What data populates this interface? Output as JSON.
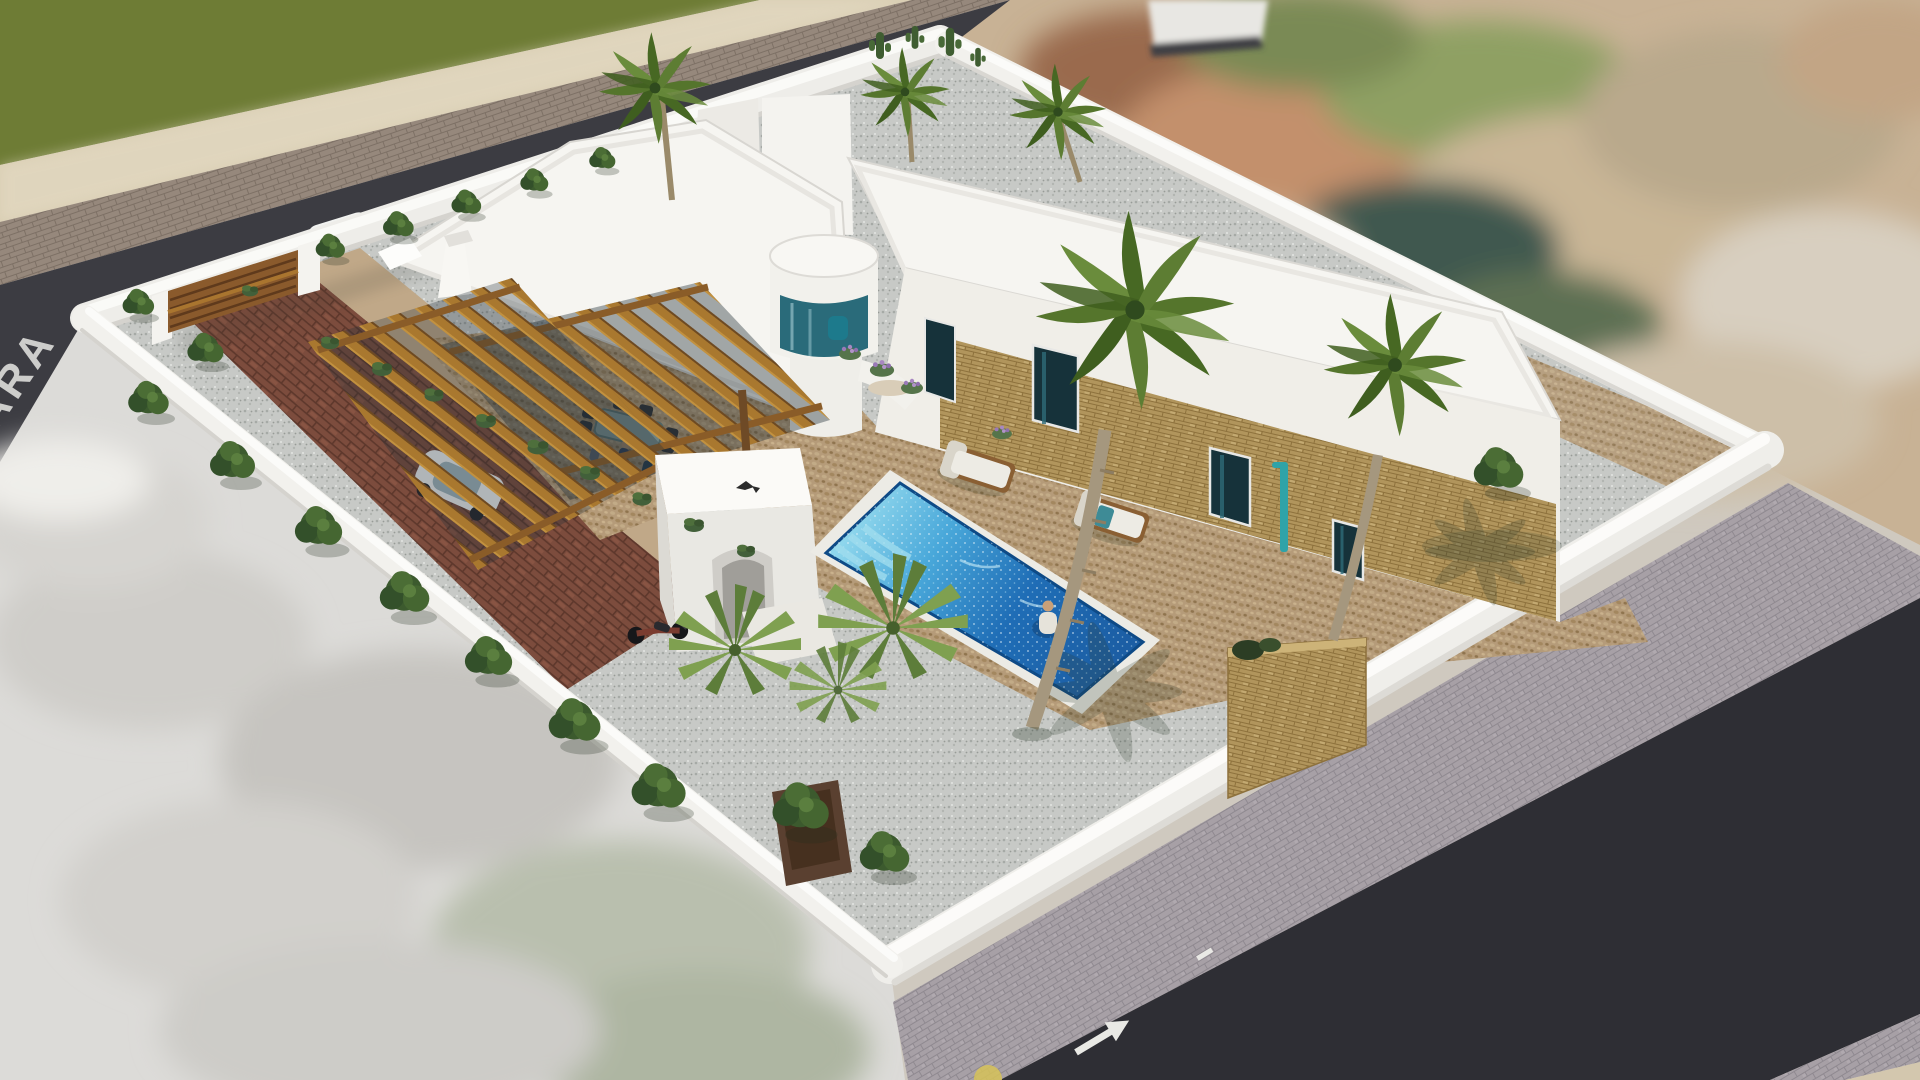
{
  "scene": {
    "title": "Aerial 3D architectural rendering of a walled Mediterranean villa with swimming pool",
    "type": "architectural-visualization",
    "view": "isometric aerial"
  },
  "road_marking": {
    "text": "ARA"
  },
  "colors": {
    "field_green": "#6e7c35",
    "sand": "#d9ceb3",
    "asphalt_top": "#3c3c42",
    "asphalt_bottom": "#2e2e34",
    "sidewalk_top": "#96887c",
    "sidewalk_bottom": "#a7a0a6",
    "wall_white": "#efeeea",
    "roof_white": "#f6f5f1",
    "facade_white": "#f0eee8",
    "deck_tan": "#b59b79",
    "gravel_gray": "#c7c9c6",
    "brick_red": "#7c4c3d",
    "pool_rim": "#ecebe5",
    "pool_deep": "#1c5ea4",
    "glass_teal": "#2a6b7a",
    "pergola_wood": "#a9782f",
    "gate_wood": "#8a5a2c",
    "stone_tan": "#b1955c",
    "palm_green": "#55752c",
    "tree_green": "#3c5a2e",
    "shower_teal": "#2fa3a8",
    "marking_white": "#f2f2ee",
    "terrain_salmon": "#c3906c",
    "arrow_white": "#e9e9e5"
  },
  "objects": {
    "main_villa": "white flat-roof villa with curved glass bay and stone-clad facade",
    "pool": {
      "people_in_water": 1,
      "shape": "rectangular",
      "steps": 3
    },
    "pool_pavilion": "white arched outdoor-kitchen pavilion",
    "pergolas": 2,
    "palm_trees": 6,
    "fan_palms": 2,
    "garden_trees": 16,
    "sun_loungers": 2,
    "dining_set": {
      "chairs": 6,
      "people": 3
    },
    "vehicles": [
      "white buggy under carport",
      "white car on road",
      "motorcycle"
    ],
    "gate": "wooden driveway gate",
    "stone_feature_wall": 1,
    "outdoor_shower": 1
  }
}
